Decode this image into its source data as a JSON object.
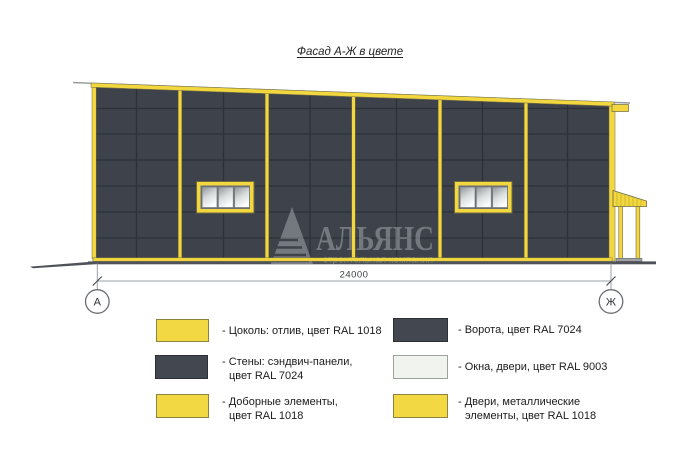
{
  "title": "Фасад А-Ж в цвете",
  "drawing": {
    "dimension_label": "24000",
    "axis_left_label": "А",
    "axis_right_label": "Ж"
  },
  "watermark": {
    "company": "АЛЬЯНС",
    "tagline": "строительная компания"
  },
  "colors": {
    "facade_yellow_ral1018": "#F2D73E",
    "wall_dark_ral7024": "#3E434B",
    "window_light_ral9003": "#F1F4EE"
  },
  "legend": {
    "items": [
      {
        "color": "#F2D843",
        "lines": [
          "- Цоколь: отлив, цвет RAL 1018"
        ]
      },
      {
        "color": "#424750",
        "lines": [
          "- Ворота, цвет RAL 7024"
        ]
      },
      {
        "color": "#424750",
        "lines": [
          "- Стены: сэндвич-панели,",
          "цвет RAL 7024"
        ]
      },
      {
        "color": "#F1F4EE",
        "lines": [
          "- Окна, двери, цвет RAL 9003"
        ]
      },
      {
        "color": "#F2D843",
        "lines": [
          "- Доборные элементы,",
          "цвет RAL 1018"
        ]
      },
      {
        "color": "#F2D843",
        "lines": [
          "- Двери, металлические",
          "элементы, цвет RAL 1018"
        ]
      }
    ]
  }
}
